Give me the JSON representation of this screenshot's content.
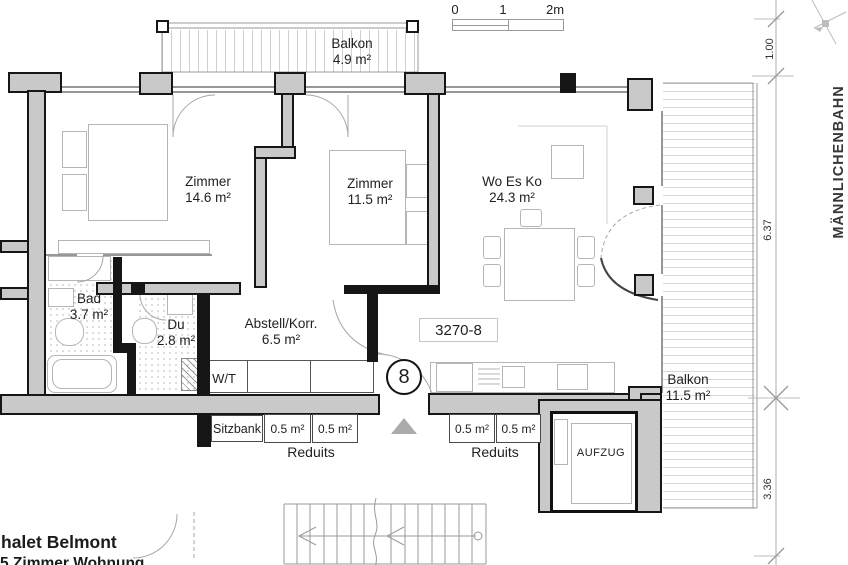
{
  "colors": {
    "wall_fill": "#c9c9c9",
    "wall_line": "#161616",
    "furniture_line": "#b5b5b5",
    "hatch_line": "#d2d2d2",
    "text": "#1f1f1f"
  },
  "scale_bar": {
    "t0": "0",
    "t1": "1",
    "t2": "2m"
  },
  "rooms": {
    "balkon_top": {
      "name": "Balkon",
      "area": "4.9 m²"
    },
    "zimmer1": {
      "name": "Zimmer",
      "area": "14.6 m²"
    },
    "zimmer2": {
      "name": "Zimmer",
      "area": "11.5 m²"
    },
    "woesko": {
      "name": "Wo Es Ko",
      "area": "24.3 m²"
    },
    "bad": {
      "name": "Bad",
      "area": "3.7 m²"
    },
    "du": {
      "name": "Du",
      "area": "2.8 m²"
    },
    "abstell": {
      "name": "Abstell/Korr.",
      "area": "6.5 m²"
    },
    "balkon_right": {
      "name": "Balkon",
      "area": "11.5 m²"
    }
  },
  "features": {
    "wt": "W/T",
    "sitzbank": "Sitzbank",
    "aufzug": "AUFZUG",
    "reduits_label": "Reduits",
    "reduit_cell": "0.5 m²"
  },
  "unit": {
    "number": "3270-8",
    "position_circle": "8"
  },
  "dimensions": {
    "d1": "1.00",
    "d2": "6.37",
    "d3": "3.36"
  },
  "street": "MÄNNLICHENBAHN",
  "footer": {
    "line1": "halet Belmont",
    "line2": "5 Zimmer Wohnung"
  }
}
